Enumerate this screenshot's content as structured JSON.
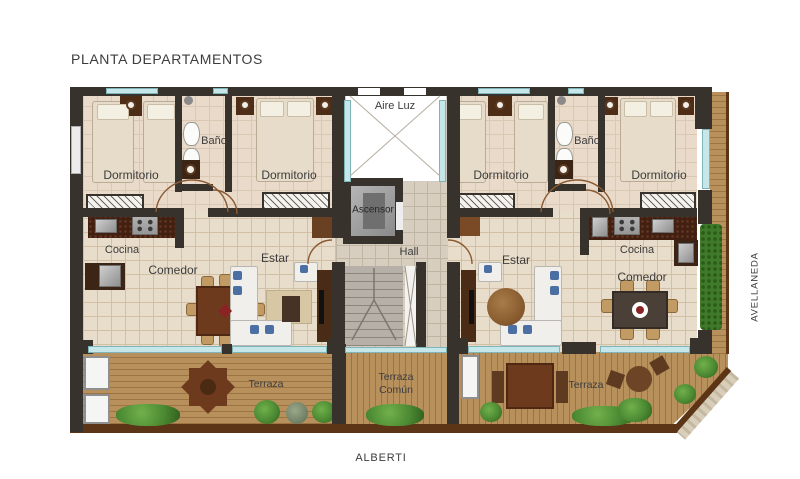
{
  "title": "PLANTA DEPARTAMENTOS",
  "streets": {
    "bottom": "ALBERTI",
    "right": "AVELLANEDA"
  },
  "core": {
    "aire_luz": "Aire Luz",
    "ascensor": "Ascensor",
    "hall": "Hall",
    "terraza_comun_line1": "Terraza",
    "terraza_comun_line2": "Común"
  },
  "apt_left": {
    "dormitorio_1": "Dormitorio",
    "bano": "Baño",
    "dormitorio_2": "Dormitorio",
    "cocina": "Cocina",
    "comedor": "Comedor",
    "estar": "Estar",
    "terraza": "Terraza"
  },
  "apt_right": {
    "dormitorio_1": "Dormitorio",
    "bano": "Baño",
    "dormitorio_2": "Dormitorio",
    "estar": "Estar",
    "cocina": "Cocina",
    "comedor": "Comedor",
    "terraza": "Terraza"
  },
  "colors": {
    "wall": "#37322c",
    "floor": "#e8dccb",
    "floor_grout": "#d2c0a6",
    "hall_floor": "#d8cec0",
    "hall_grout": "#c0b4a3",
    "wood": "#b8905c",
    "wood_line": "#9c7444",
    "wood_edge": "#5c3516",
    "window": "#c6e7e9",
    "window_frame": "#7fb4b8",
    "stairs": "#b6b0a8",
    "stair_line": "#8d867c",
    "elevator": "#9b9b9b",
    "elevator_dark": "#6f6f6f",
    "counter": "#412012",
    "appliance": "#b3b3b3",
    "table_brown": "#6e3a1e",
    "table_dark": "#4a4037",
    "chair": "#c29a63",
    "sofa": "#f1efec",
    "pillow": "#4c6fa3",
    "bed": "#e6dcc9",
    "bed_edge": "#b9ab94",
    "nightstand": "#4e2d17",
    "plant": "#4c8a33",
    "plant_dark": "#2e5e1c",
    "hedge": "#3f7a2b",
    "stone": "#d8ceba",
    "arc": "#8a5a32",
    "text": "#3c3c3c"
  }
}
